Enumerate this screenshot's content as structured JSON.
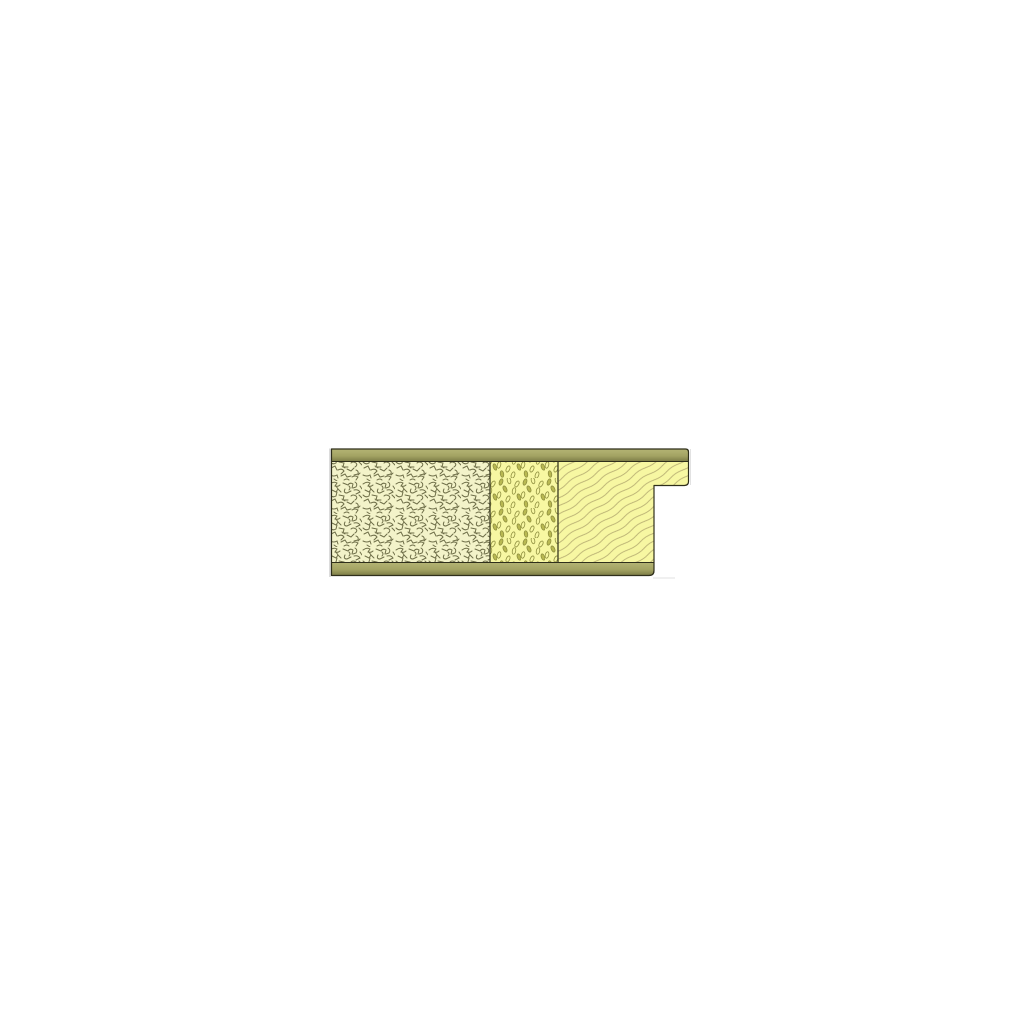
{
  "page": {
    "background": "#ffffff",
    "title": "sandwich-panel-section-detail"
  },
  "drawing": {
    "colors": {
      "outline": "#2f2f1b",
      "divider": "#3a3a22",
      "skin_top": "#b4b474",
      "skin_mid": "#a3a363",
      "skin_low": "#7c7c47",
      "core_a_bg": "#f3f3c9",
      "core_b_bg": "#f7f7a2",
      "core_c_bg": "#f7f7a2",
      "squiggle_stroke": "#6e6e48",
      "dot_stroke": "#8f8f3f",
      "dot_fill": "#b9b952",
      "grain_stroke": "#b7ae72",
      "edge_beyond": "#bcbcbc",
      "edge_beyond_light": "#d6d6d6"
    },
    "layers": {
      "top_skin": "top-skin-board",
      "bottom_skin": "bottom-skin-board",
      "core_left": "loose-fill-insulation-core",
      "core_middle": "rigid-insulation-core",
      "core_right": "timber-edge-member",
      "tongue": "rebated-edge-tongue"
    }
  }
}
